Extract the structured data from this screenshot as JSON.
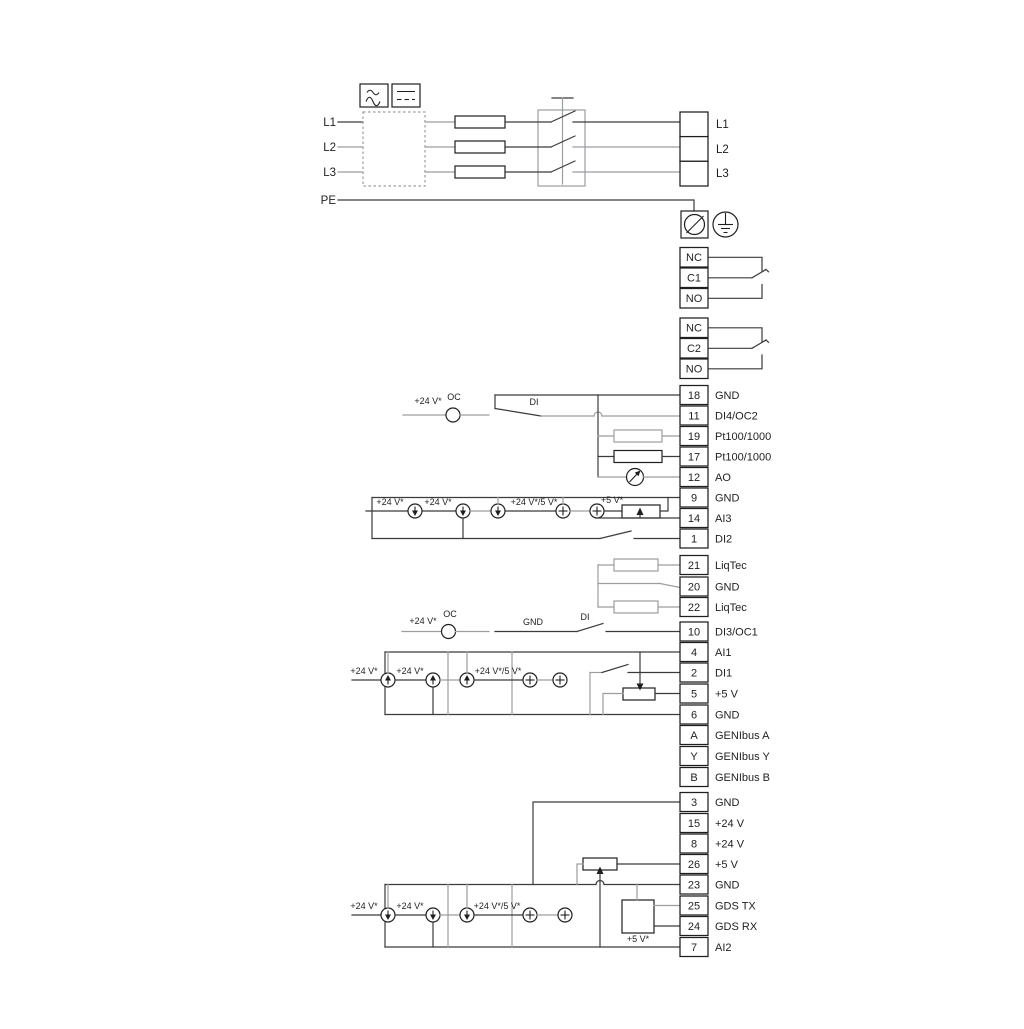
{
  "colors": {
    "wire_dark": "#3b3b3d",
    "wire_light": "#9b9da0",
    "text": "#1f1f21",
    "background": "#ffffff"
  },
  "power": {
    "left": [
      "L1",
      "L2",
      "L3"
    ],
    "pe": "PE",
    "right": [
      "L1",
      "L2",
      "L3"
    ]
  },
  "relay1": {
    "rows": [
      "NC",
      "C1",
      "NO"
    ]
  },
  "relay2": {
    "rows": [
      "NC",
      "C2",
      "NO"
    ]
  },
  "strip1": {
    "rows": [
      {
        "n": "18",
        "l": "GND"
      },
      {
        "n": "11",
        "l": "DI4/OC2"
      },
      {
        "n": "19",
        "l": "Pt100/1000"
      },
      {
        "n": "17",
        "l": "Pt100/1000"
      },
      {
        "n": "12",
        "l": "AO"
      },
      {
        "n": "9",
        "l": "GND"
      },
      {
        "n": "14",
        "l": "AI3"
      },
      {
        "n": "1",
        "l": "DI2"
      }
    ]
  },
  "liqtec": {
    "rows": [
      {
        "n": "21",
        "l": "LiqTec"
      },
      {
        "n": "20",
        "l": "GND"
      },
      {
        "n": "22",
        "l": "LiqTec"
      }
    ]
  },
  "strip2": {
    "rows": [
      {
        "n": "10",
        "l": "DI3/OC1"
      },
      {
        "n": "4",
        "l": "AI1"
      },
      {
        "n": "2",
        "l": "DI1"
      },
      {
        "n": "5",
        "l": "+5 V"
      },
      {
        "n": "6",
        "l": "GND"
      },
      {
        "n": "A",
        "l": "GENIbus A"
      },
      {
        "n": "Y",
        "l": "GENIbus Y"
      },
      {
        "n": "B",
        "l": "GENIbus B"
      }
    ]
  },
  "strip3": {
    "rows": [
      {
        "n": "3",
        "l": "GND"
      },
      {
        "n": "15",
        "l": "+24 V"
      },
      {
        "n": "8",
        "l": "+24 V"
      },
      {
        "n": "26",
        "l": "+5 V"
      },
      {
        "n": "23",
        "l": "GND"
      },
      {
        "n": "25",
        "l": "GDS TX"
      },
      {
        "n": "24",
        "l": "GDS RX"
      },
      {
        "n": "7",
        "l": "AI2"
      }
    ]
  },
  "ann": {
    "oc": "OC",
    "di": "DI",
    "gnd": "GND",
    "v24": "+24 V*",
    "v24_5": "+24 V*/5 V*",
    "v5": "+5 V*"
  }
}
